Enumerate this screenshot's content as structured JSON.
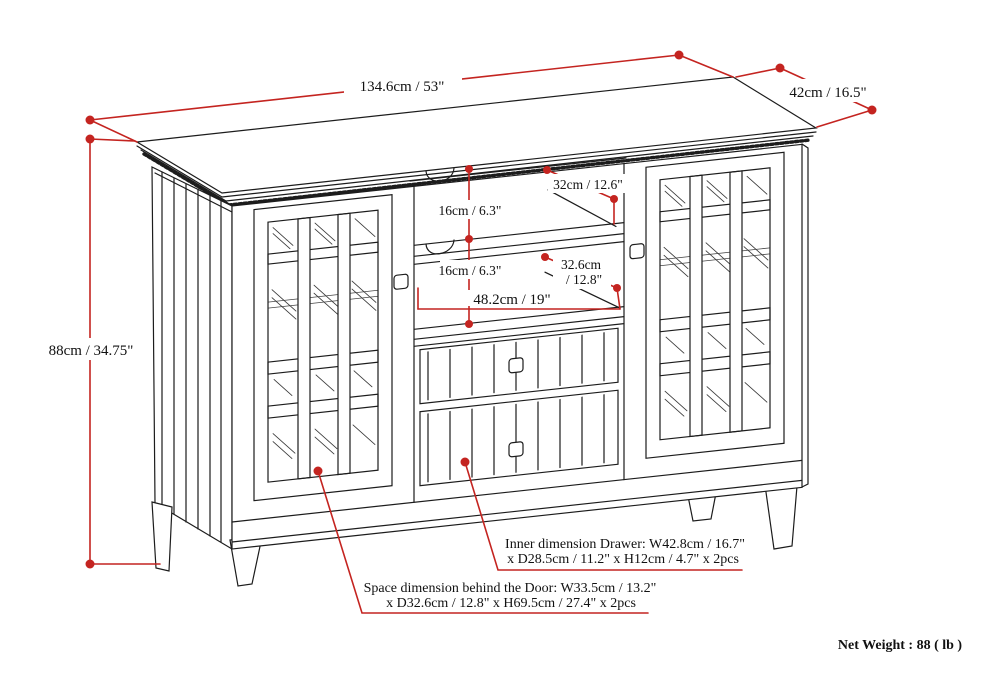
{
  "diagram": {
    "kind": "furniture-dimension-line-drawing",
    "dimensions": {
      "overall_width": "134.6cm / 53\"",
      "overall_depth": "42cm / 16.5\"",
      "overall_height": "88cm / 34.75\"",
      "top_shelf_depth": "32cm / 12.6\"",
      "top_shelf_height": "16cm / 6.3\"",
      "bottom_shelf_height": "16cm / 6.3\"",
      "bottom_shelf_depth_line1": "32.6cm",
      "bottom_shelf_depth_line2": "/ 12.8\"",
      "center_opening_width": "48.2cm / 19\""
    },
    "notes": {
      "drawer_line1": "Inner dimension Drawer: W42.8cm / 16.7\"",
      "drawer_line2": "x D28.5cm / 11.2\" x H12cm / 4.7\" x 2pcs",
      "door_line1": "Space dimension behind the Door: W33.5cm / 13.2\"",
      "door_line2": "x D32.6cm / 12.8\" x H69.5cm / 27.4\" x 2pcs"
    },
    "net_weight": "Net Weight : 88 ( lb )",
    "colors": {
      "line": "#1c1c1c",
      "dimension_red": "#c42420",
      "background": "#ffffff"
    }
  }
}
